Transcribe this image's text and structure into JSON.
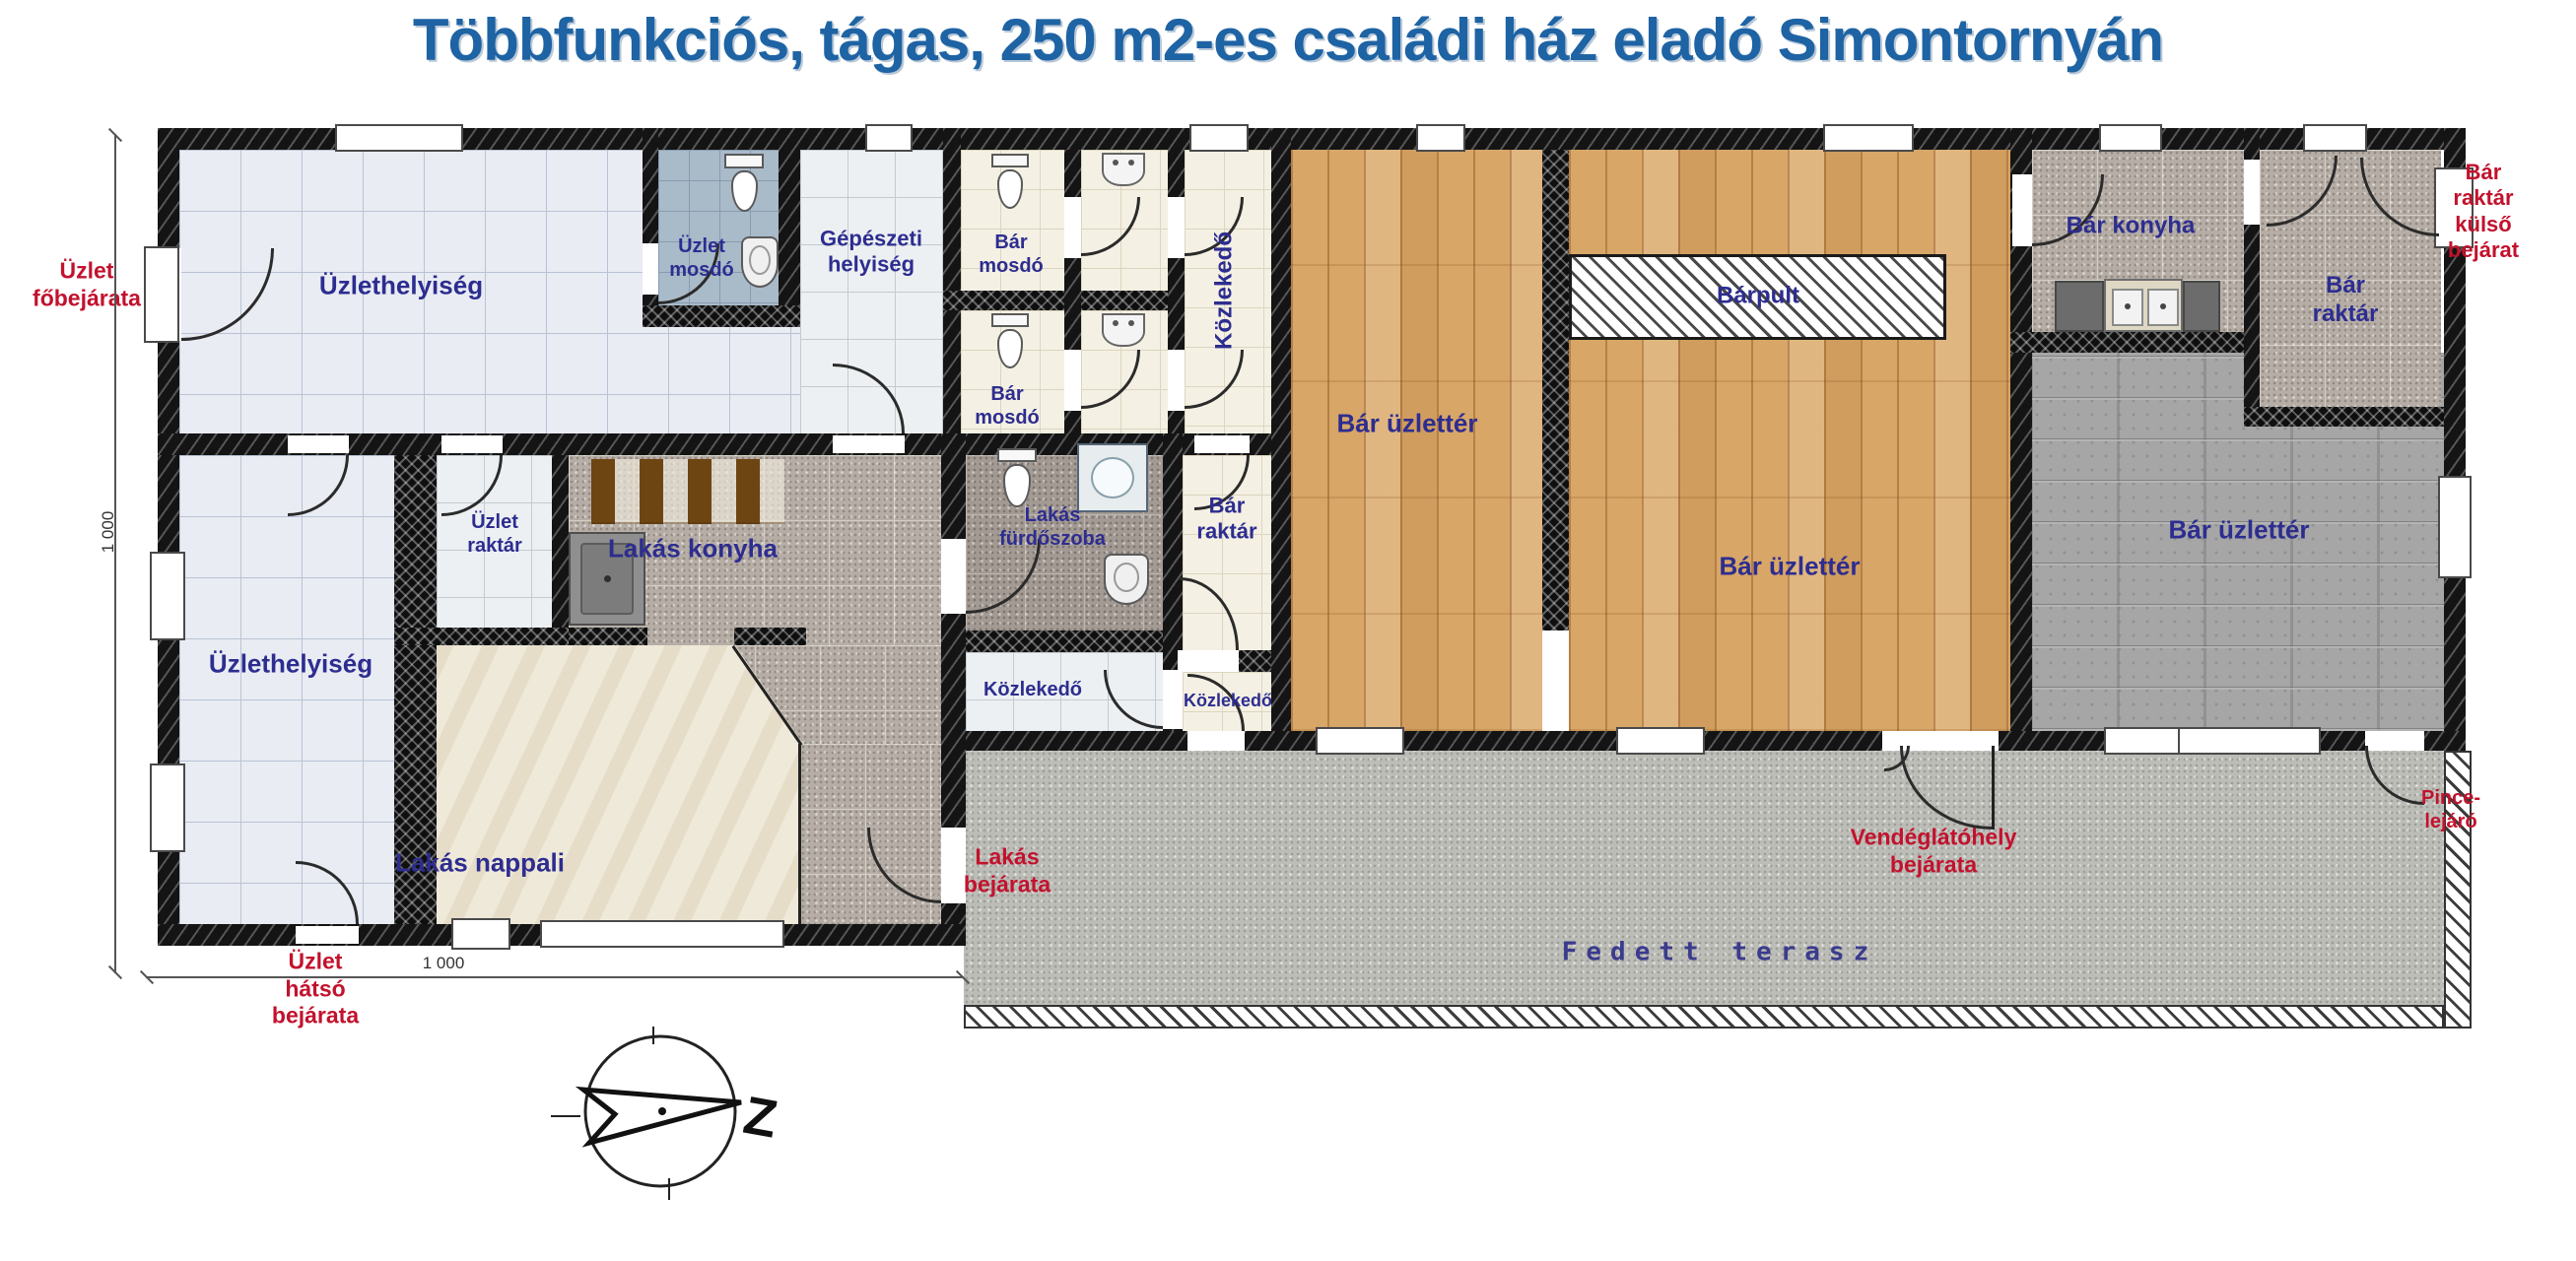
{
  "title": "Többfunkciós, tágas, 250 m2-es családi ház eladó Simontornyán",
  "rooms": {
    "uzlethelyiseg_1": "Üzlethelyiség",
    "uzlet_mosdo": "Üzlet\nmosdó",
    "gepeszeti_helyiseg": "Gépészeti\nhelyiség",
    "bar_mosdo_1": "Bár\nmosdó",
    "bar_mosdo_2": "Bár\nmosdó",
    "kozlekedo_felso": "Közlekedő",
    "bar_uzletter_1": "Bár üzlettér",
    "barpult": "Bárpult",
    "bar_uzletter_2": "Bár üzlettér",
    "bar_konyha": "Bár konyha",
    "bar_raktar_jobb_felso": "Bár\nraktár",
    "bar_uzletter_3": "Bár üzlettér",
    "uzlet_raktar": "Üzlet\nraktár",
    "lakas_konyha": "Lakás konyha",
    "lakas_furdoszoba": "Lakás\nfürdőszoba",
    "bar_raktar_kozep": "Bár\nraktár",
    "uzlethelyiseg_2": "Üzlethelyiség",
    "lakas_nappali": "Lakás nappali",
    "kozlekedo_bal": "Közlekedő",
    "kozlekedo_jobb": "Közlekedő",
    "fedett_terasz": "Fedett terasz"
  },
  "entrances": {
    "uzlet_fobejarata": "Üzlet\nfőbejárata",
    "bar_raktar_kulso_bejarat": "Bár\nraktár\nkülső\nbejárat",
    "uzlet_hatso_bejarata": "Üzlet\nhátsó\nbejárata",
    "lakas_bejarata": "Lakás\nbejárata",
    "vendeglatohely_bejarata": "Vendéglátóhely\nbejárata",
    "pince_lejaro": "Pince-\nlejáró"
  },
  "dimensions": {
    "left_vertical": "1 000",
    "bottom_horizontal": "1 000"
  },
  "compass": {
    "north_letter": "Z"
  },
  "colors": {
    "title": "#1e63a4",
    "room_label": "#2d2d90",
    "entrance_label": "#c2122d",
    "wall": "#141414",
    "wood_floor": "#d8a667",
    "terrace_floor": "#bdbdb8"
  },
  "icons": {
    "toilet-icon": "tank+oval-bowl shape",
    "sink-icon": "rounded-basin shape",
    "shower-icon": "square-with-circle shape",
    "kitchen-cabinet-icon": "brown-stripe band",
    "bar-counter-icon": "diagonal-hatch rectangle",
    "compass-icon": "circle-with-arrow"
  }
}
